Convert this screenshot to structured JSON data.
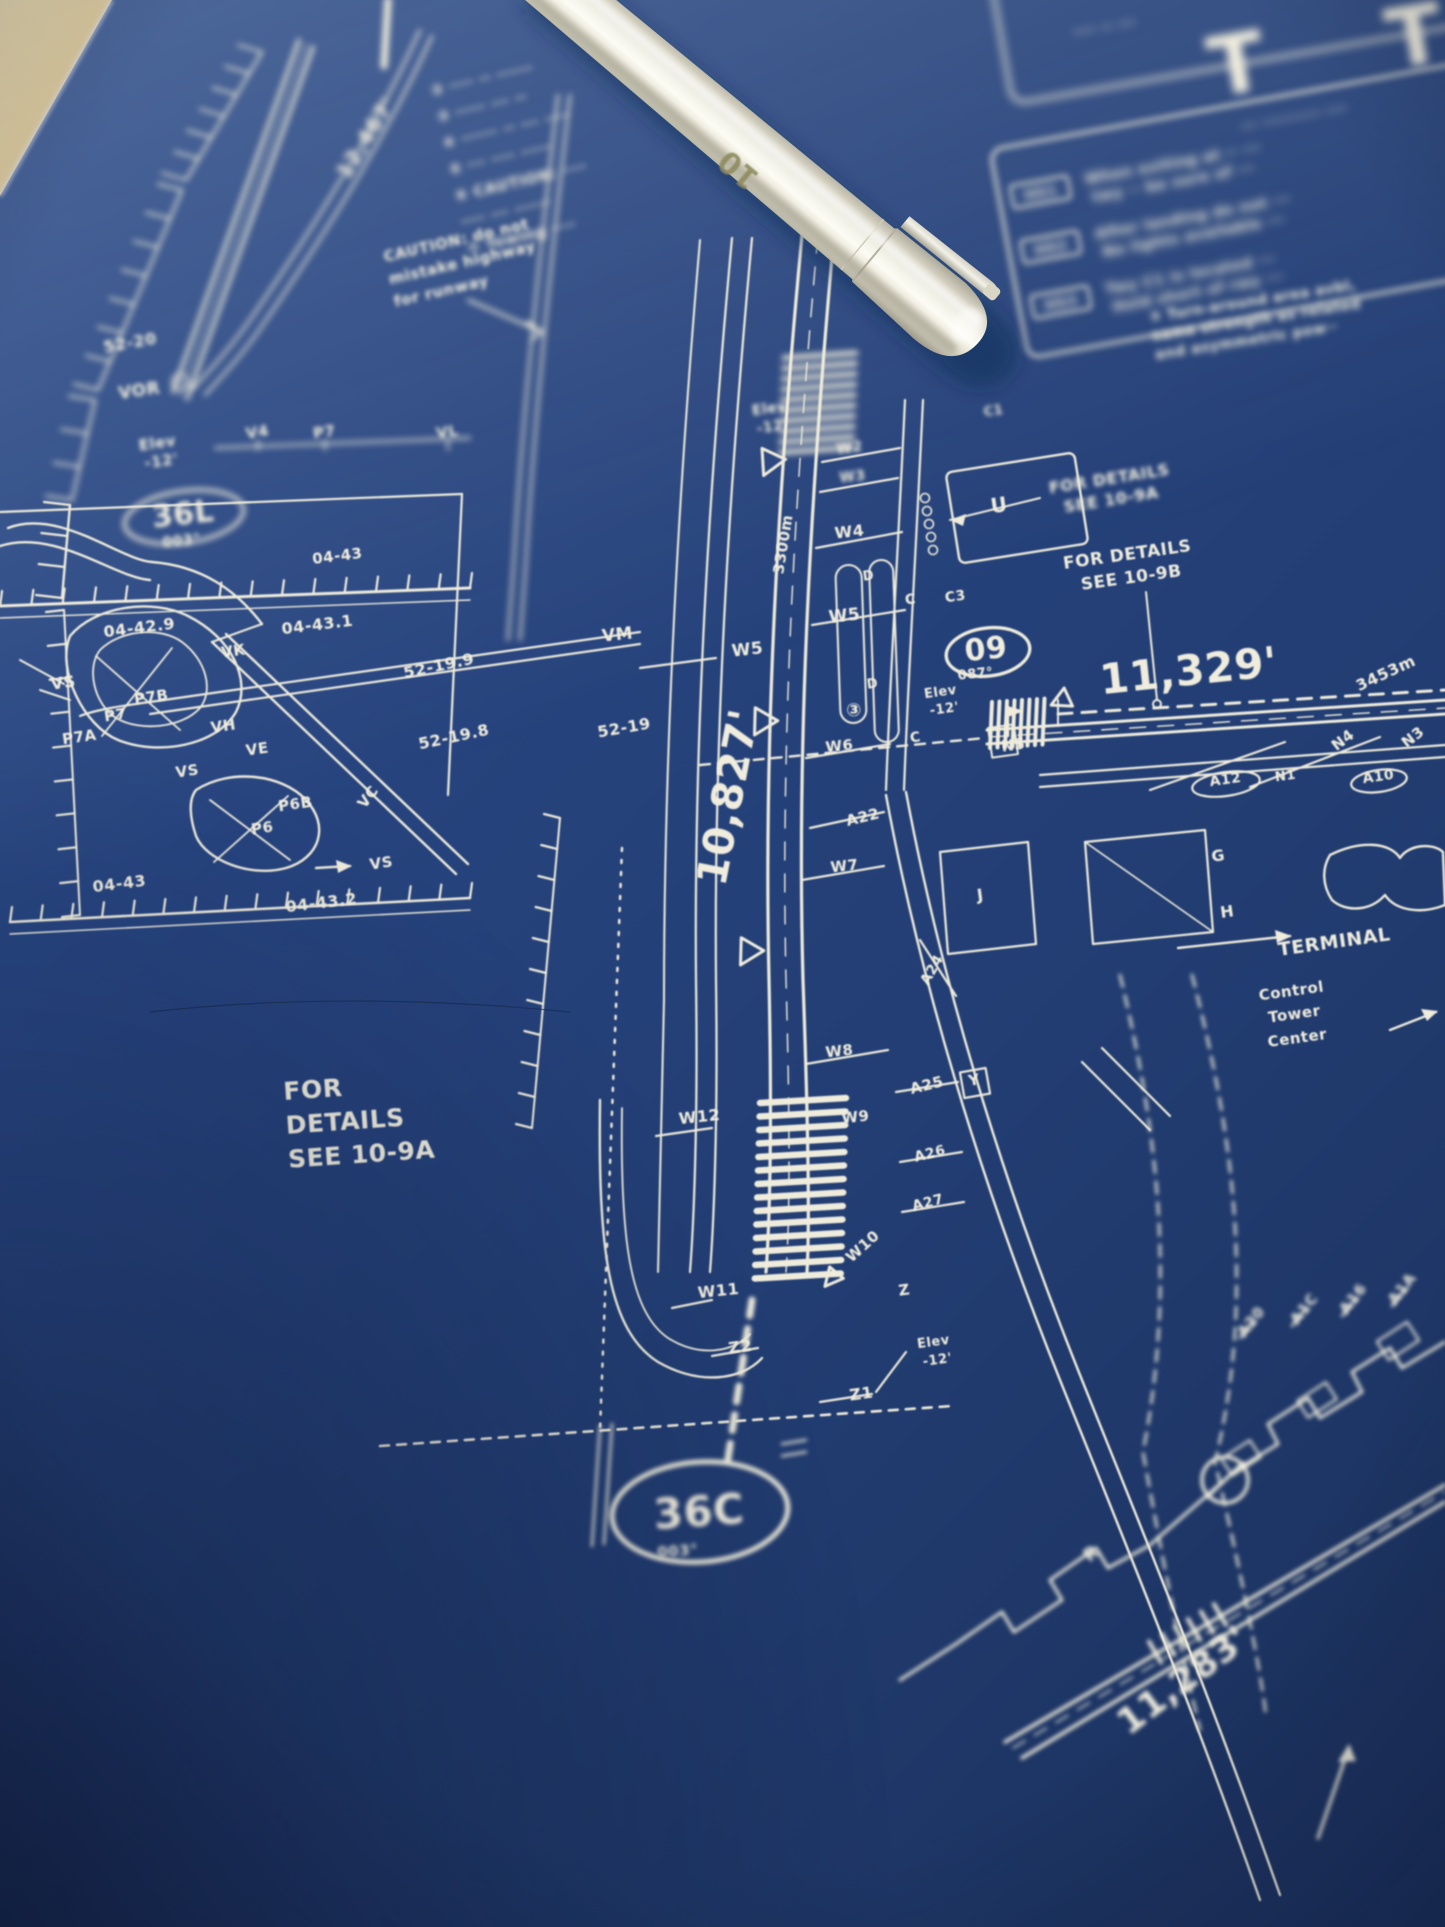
{
  "photo": {
    "surface_color": "#d8c18e",
    "paper_color": "#24407a",
    "line_color": "#efecdc",
    "pen": {
      "marking": "10",
      "body_color": "#eeebdd"
    }
  },
  "blueprint": {
    "airport": {
      "runway_36L": {
        "designator": "36L",
        "heading": "003°",
        "length_ft": "12,467'"
      },
      "runway_36C": {
        "designator": "36C",
        "heading": "003°",
        "length_ft": "10,827'",
        "length_m": "3300m"
      },
      "runway_09": {
        "designator": "09",
        "heading": "087°",
        "length_ft": "11,329'",
        "length_m": "3453m"
      },
      "runway_diagonal_bottom": {
        "length_ft": "11,283'"
      }
    },
    "notes": {
      "caution_top": {
        "x": 432,
        "y": 96,
        "r": -13,
        "s": 15,
        "lh": 27,
        "f": "f3",
        "lines": [
          "② ···· ·· ······",
          "③ ····· ··· ··",
          "④ ······ ·· ··· ····",
          "⑤ ··· ···· ·····",
          "⑥ CAUTION: ····",
          "   ···· ··· ······",
          "⑦ Towing ····"
        ]
      },
      "caution_mid": {
        "x": 385,
        "y": 262,
        "r": -13,
        "s": 15,
        "lh": 23,
        "f": "f2",
        "lines": [
          "CAUTION: do not",
          "mistake highway",
          "for runway"
        ]
      },
      "turn_around": {
        "x": 1150,
        "y": 322,
        "r": -9,
        "s": 14,
        "lh": 19,
        "f": "f3",
        "lines": [
          "③ Turn-around area avbl,",
          "same strength as related",
          "and asymmetric pow··"
        ]
      },
      "details_left": {
        "x": 284,
        "y": 1100,
        "r": -4,
        "s": 25,
        "lh": 34,
        "f": "f1",
        "lines": [
          "FOR",
          "DETAILS",
          "SEE 10-9A"
        ]
      }
    },
    "hotspot_table": {
      "header": "··· ··········· ····",
      "rows": [
        {
          "id": "HS1",
          "lines": [
            "When exiting at ·· ···",
            "twy ·· be sure of ···"
          ]
        },
        {
          "id": "HS2",
          "lines": [
            "After landing do not ···",
            "No lights available ···"
          ]
        },
        {
          "id": "HS3",
          "lines": [
            "Twy C1 is located ···",
            "Hold short of rwy ···"
          ]
        }
      ]
    },
    "svg_labels": [
      {
        "t": "12,467'",
        "x": 372,
        "y": 142,
        "r": -58,
        "s": 21,
        "f": "f3"
      },
      {
        "t": "T",
        "x": 1242,
        "y": 92,
        "r": -10,
        "s": 82,
        "f": "f4"
      },
      {
        "t": "T",
        "x": 1420,
        "y": 64,
        "r": -10,
        "s": 82,
        "f": "f4"
      },
      {
        "t": "···· ·· ···",
        "x": 1105,
        "y": 32,
        "r": -10,
        "s": 14,
        "f": "f4"
      },
      {
        "t": "52-20",
        "x": 131,
        "y": 348,
        "r": -10,
        "s": 16,
        "f": "f2"
      },
      {
        "t": "VOR",
        "x": 140,
        "y": 396,
        "r": -8,
        "s": 17,
        "f": "f2"
      },
      {
        "t": "Elev",
        "x": 158,
        "y": 448,
        "r": -8,
        "s": 15,
        "f": "f2"
      },
      {
        "t": "-12'",
        "x": 162,
        "y": 466,
        "r": -8,
        "s": 15,
        "f": "f2"
      },
      {
        "t": "36L",
        "x": 184,
        "y": 524,
        "r": -6,
        "s": 30,
        "f": "f2"
      },
      {
        "t": "003°",
        "x": 182,
        "y": 545,
        "r": -6,
        "s": 14,
        "f": "f2"
      },
      {
        "t": "V4",
        "x": 258,
        "y": 437,
        "r": -8,
        "s": 15,
        "f": "f2"
      },
      {
        "t": "P7",
        "x": 325,
        "y": 437,
        "r": -8,
        "s": 15,
        "f": "f2"
      },
      {
        "t": "VL",
        "x": 448,
        "y": 437,
        "r": -8,
        "s": 15,
        "f": "f2"
      },
      {
        "t": "04-43",
        "x": 338,
        "y": 561,
        "r": -7,
        "s": 15
      },
      {
        "t": "04-42.9",
        "x": 140,
        "y": 633,
        "r": -7,
        "s": 16
      },
      {
        "t": "04-43.1",
        "x": 318,
        "y": 630,
        "r": -7,
        "s": 16
      },
      {
        "t": "52-19.9",
        "x": 440,
        "y": 671,
        "r": -12,
        "s": 16
      },
      {
        "t": "52-19.8",
        "x": 455,
        "y": 742,
        "r": -12,
        "s": 16
      },
      {
        "t": "52-19",
        "x": 625,
        "y": 733,
        "r": -10,
        "s": 16
      },
      {
        "t": "04-43",
        "x": 120,
        "y": 889,
        "r": -7,
        "s": 16
      },
      {
        "t": "04-43.2",
        "x": 322,
        "y": 908,
        "r": -7,
        "s": 16
      },
      {
        "t": "VS",
        "x": 64,
        "y": 688,
        "r": -8,
        "s": 16
      },
      {
        "t": "P7B",
        "x": 152,
        "y": 702,
        "r": -8,
        "s": 15
      },
      {
        "t": "P7",
        "x": 116,
        "y": 720,
        "r": -8,
        "s": 15
      },
      {
        "t": "P7A",
        "x": 80,
        "y": 742,
        "r": -8,
        "s": 15
      },
      {
        "t": "VH",
        "x": 224,
        "y": 731,
        "r": -8,
        "s": 15
      },
      {
        "t": "VE",
        "x": 258,
        "y": 754,
        "r": -8,
        "s": 15
      },
      {
        "t": "VS",
        "x": 188,
        "y": 776,
        "r": -8,
        "s": 15
      },
      {
        "t": "P6B",
        "x": 296,
        "y": 809,
        "r": -8,
        "s": 15
      },
      {
        "t": "P6",
        "x": 263,
        "y": 833,
        "r": -8,
        "s": 15
      },
      {
        "t": "VC",
        "x": 372,
        "y": 800,
        "r": -52,
        "s": 15
      },
      {
        "t": "VS",
        "x": 382,
        "y": 868,
        "r": -8,
        "s": 15
      },
      {
        "t": "VK",
        "x": 234,
        "y": 656,
        "r": -8,
        "s": 15
      },
      {
        "t": "VM",
        "x": 618,
        "y": 640,
        "r": -6,
        "s": 17
      },
      {
        "t": "W5",
        "x": 748,
        "y": 655,
        "r": -6,
        "s": 17
      },
      {
        "t": "W5",
        "x": 845,
        "y": 621,
        "r": -6,
        "s": 17
      },
      {
        "t": "W6",
        "x": 840,
        "y": 751,
        "r": -6,
        "s": 15
      },
      {
        "t": "③",
        "x": 854,
        "y": 716,
        "r": 0,
        "s": 18
      },
      {
        "t": "W7",
        "x": 845,
        "y": 871,
        "r": -6,
        "s": 15
      },
      {
        "t": "A22",
        "x": 864,
        "y": 822,
        "r": -14,
        "s": 15
      },
      {
        "t": "A24",
        "x": 936,
        "y": 972,
        "r": -60,
        "s": 14
      },
      {
        "t": "W8",
        "x": 840,
        "y": 1056,
        "r": -6,
        "s": 15
      },
      {
        "t": "A25",
        "x": 928,
        "y": 1090,
        "r": -14,
        "s": 15
      },
      {
        "t": "Y",
        "x": 975,
        "y": 1085,
        "r": -10,
        "s": 15
      },
      {
        "t": "A26",
        "x": 931,
        "y": 1158,
        "r": -14,
        "s": 14
      },
      {
        "t": "A27",
        "x": 929,
        "y": 1207,
        "r": -14,
        "s": 14
      },
      {
        "t": "W9",
        "x": 856,
        "y": 1122,
        "r": -6,
        "s": 15
      },
      {
        "t": "W12",
        "x": 700,
        "y": 1122,
        "r": -6,
        "s": 16
      },
      {
        "t": "W10",
        "x": 866,
        "y": 1250,
        "r": -42,
        "s": 15
      },
      {
        "t": "W11",
        "x": 719,
        "y": 1296,
        "r": -6,
        "s": 16
      },
      {
        "t": "Z2",
        "x": 741,
        "y": 1352,
        "r": -8,
        "s": 16
      },
      {
        "t": "Z",
        "x": 905,
        "y": 1295,
        "r": -8,
        "s": 15
      },
      {
        "t": "Z1",
        "x": 862,
        "y": 1399,
        "r": -8,
        "s": 16
      },
      {
        "t": "Elev",
        "x": 934,
        "y": 1346,
        "r": -8,
        "s": 13
      },
      {
        "t": "-12'",
        "x": 938,
        "y": 1364,
        "r": -8,
        "s": 13
      },
      {
        "t": "10,827'",
        "x": 742,
        "y": 800,
        "r": -79,
        "s": 42
      },
      {
        "t": "3300m",
        "x": 788,
        "y": 545,
        "r": -81,
        "s": 15
      },
      {
        "t": "36C",
        "x": 700,
        "y": 1526,
        "r": -4,
        "s": 42,
        "f": "f2"
      },
      {
        "t": "003°",
        "x": 678,
        "y": 1556,
        "r": -4,
        "s": 15,
        "f": "f2"
      },
      {
        "t": "Elev",
        "x": 770,
        "y": 413,
        "r": -8,
        "s": 14,
        "f": "f2"
      },
      {
        "t": "-12'",
        "x": 773,
        "y": 431,
        "r": -8,
        "s": 14,
        "f": "f2"
      },
      {
        "t": "W2",
        "x": 850,
        "y": 452,
        "r": -6,
        "s": 14,
        "f": "f2"
      },
      {
        "t": "W3",
        "x": 853,
        "y": 481,
        "r": -6,
        "s": 14,
        "f": "f2"
      },
      {
        "t": "W4",
        "x": 850,
        "y": 537,
        "r": -6,
        "s": 16
      },
      {
        "t": "C1",
        "x": 994,
        "y": 415,
        "r": -8,
        "s": 13,
        "f": "f2"
      },
      {
        "t": "U",
        "x": 1000,
        "y": 512,
        "r": -8,
        "s": 20
      },
      {
        "t": "C",
        "x": 911,
        "y": 604,
        "r": -8,
        "s": 14
      },
      {
        "t": "C3",
        "x": 956,
        "y": 601,
        "r": -8,
        "s": 14
      },
      {
        "t": "C",
        "x": 916,
        "y": 742,
        "r": -8,
        "s": 14
      },
      {
        "t": "D",
        "x": 869,
        "y": 580,
        "r": -8,
        "s": 13
      },
      {
        "t": "D",
        "x": 873,
        "y": 688,
        "r": -8,
        "s": 13
      },
      {
        "t": "09",
        "x": 987,
        "y": 659,
        "r": -6,
        "s": 30
      },
      {
        "t": "087°",
        "x": 976,
        "y": 678,
        "r": -6,
        "s": 13
      },
      {
        "t": "Elev",
        "x": 941,
        "y": 696,
        "r": -8,
        "s": 13
      },
      {
        "t": "-12'",
        "x": 945,
        "y": 713,
        "r": -8,
        "s": 13
      },
      {
        "t": "11,329'",
        "x": 1190,
        "y": 685,
        "r": -6,
        "s": 42
      },
      {
        "t": "3453m",
        "x": 1388,
        "y": 678,
        "r": -25,
        "s": 16
      },
      {
        "t": "N5",
        "x": 1014,
        "y": 750,
        "r": -8,
        "s": 15
      },
      {
        "t": "N4",
        "x": 1346,
        "y": 744,
        "r": -38,
        "s": 15
      },
      {
        "t": "N3",
        "x": 1416,
        "y": 741,
        "r": -38,
        "s": 15
      },
      {
        "t": "A12",
        "x": 1226,
        "y": 784,
        "r": -8,
        "s": 14
      },
      {
        "t": "N1",
        "x": 1286,
        "y": 780,
        "r": -8,
        "s": 13
      },
      {
        "t": "A10",
        "x": 1379,
        "y": 781,
        "r": -8,
        "s": 14
      },
      {
        "t": "G",
        "x": 1219,
        "y": 861,
        "r": -8,
        "s": 16
      },
      {
        "t": "H",
        "x": 1228,
        "y": 917,
        "r": -8,
        "s": 16
      },
      {
        "t": "J",
        "x": 981,
        "y": 900,
        "r": -8,
        "s": 16
      },
      {
        "t": "TERMINAL",
        "x": 1335,
        "y": 948,
        "r": -8,
        "s": 19,
        "ls": 2
      },
      {
        "t": "Control",
        "x": 1292,
        "y": 996,
        "r": -8,
        "s": 15
      },
      {
        "t": "Tower",
        "x": 1295,
        "y": 1019,
        "r": -8,
        "s": 15
      },
      {
        "t": "Center",
        "x": 1298,
        "y": 1043,
        "r": -8,
        "s": 15
      },
      {
        "t": "FOR DETAILS",
        "x": 1110,
        "y": 484,
        "r": -9,
        "s": 16,
        "f": "f2"
      },
      {
        "t": "SEE 10-9A",
        "x": 1112,
        "y": 505,
        "r": -9,
        "s": 16,
        "f": "f2"
      },
      {
        "t": "FOR DETAILS",
        "x": 1128,
        "y": 560,
        "r": -8,
        "s": 17
      },
      {
        "t": "SEE 10-9B",
        "x": 1132,
        "y": 583,
        "r": -8,
        "s": 17
      },
      {
        "t": "11,283'",
        "x": 1190,
        "y": 1690,
        "r": -37,
        "s": 36,
        "f": "f2"
      },
      {
        "t": "R",
        "x": 1095,
        "y": 1558,
        "r": -40,
        "s": 18,
        "f": "f2"
      },
      {
        "t": "A20",
        "x": 1255,
        "y": 1325,
        "r": -52,
        "s": 15,
        "f": "f2"
      },
      {
        "t": "A1C",
        "x": 1308,
        "y": 1312,
        "r": -52,
        "s": 15,
        "f": "f2"
      },
      {
        "t": "A16",
        "x": 1357,
        "y": 1302,
        "r": -52,
        "s": 15,
        "f": "f2"
      },
      {
        "t": "A1A",
        "x": 1406,
        "y": 1292,
        "r": -52,
        "s": 15,
        "f": "f2"
      }
    ]
  }
}
